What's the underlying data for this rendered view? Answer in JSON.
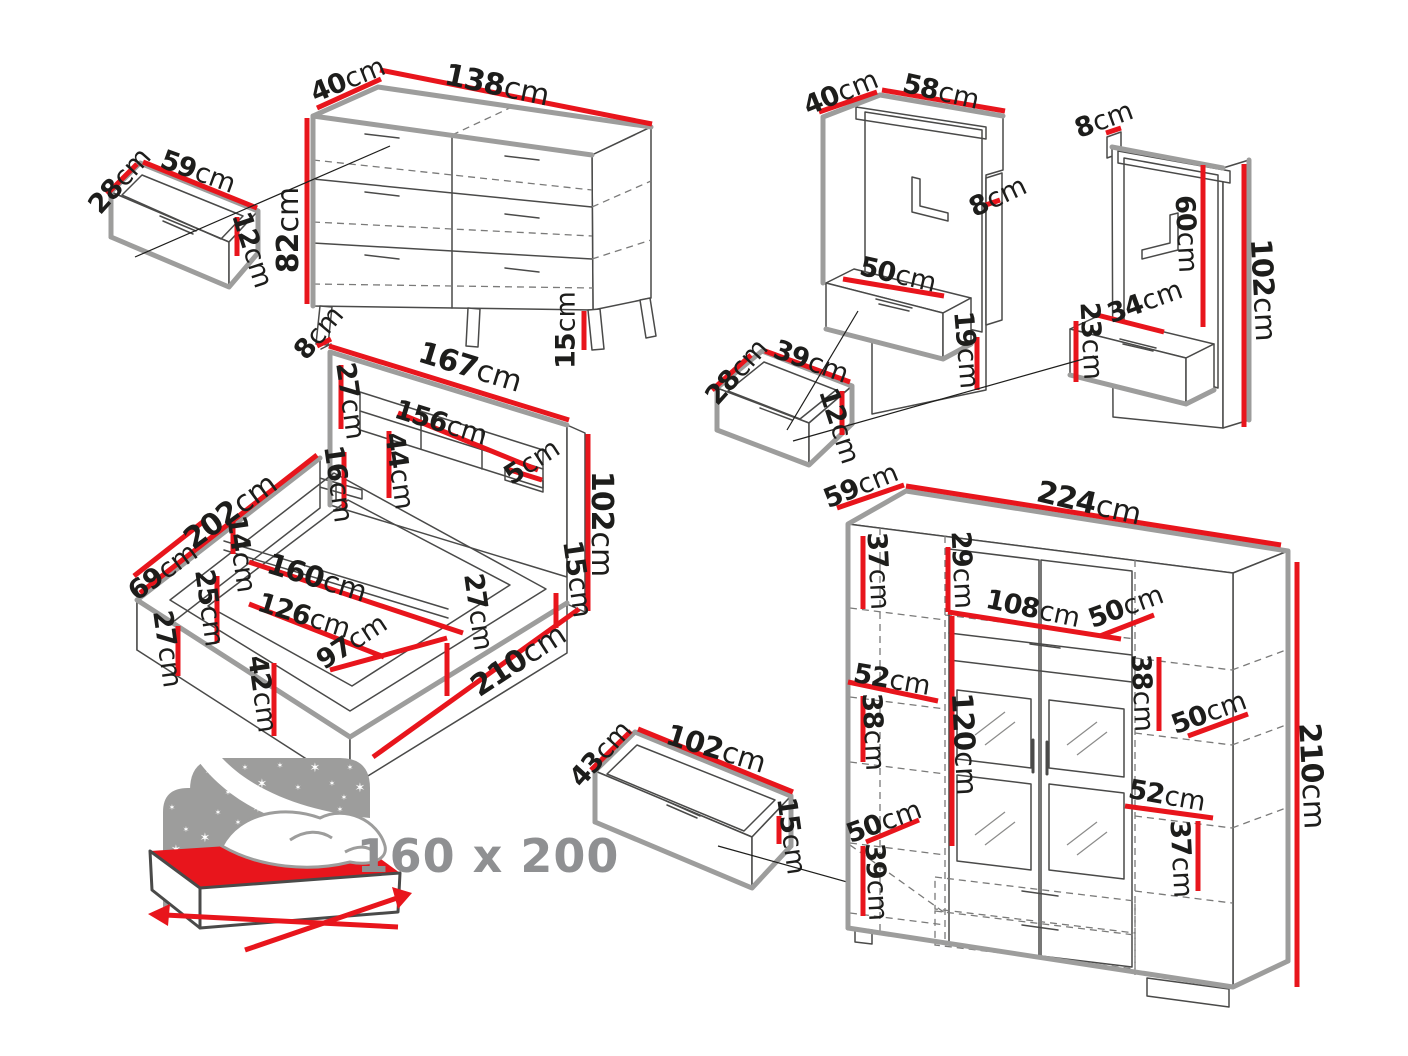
{
  "title": "Bedroom furniture set dimensions diagram",
  "unit": "cm",
  "bed_size_label": "160 x 200",
  "colors": {
    "dimension_red": "#e8151c",
    "outline_gray": "#9d9d9c",
    "line_dark": "#4a4a49",
    "dashed_gray": "#7a7a79",
    "text_dark": "#1d1d1b",
    "pictogram_gray": "#9d9d9c",
    "pictogram_text_gray": "#8f9092",
    "background": "#ffffff"
  },
  "furniture": [
    {
      "name": "chest-of-drawers",
      "dimension_labels_cm": [
        40,
        138,
        82,
        15
      ]
    },
    {
      "name": "chest-drawer-box",
      "dimension_labels_cm": [
        28,
        59,
        12
      ]
    },
    {
      "name": "bed-frame",
      "dimension_labels_cm": [
        8,
        167,
        27,
        156,
        44,
        16,
        5,
        102,
        202,
        14,
        160,
        126,
        69,
        25,
        97,
        27,
        42,
        27,
        15,
        210
      ]
    },
    {
      "name": "under-bed-drawer",
      "dimension_labels_cm": [
        43,
        102,
        15
      ]
    },
    {
      "name": "wall-panel-left",
      "dimension_labels_cm": [
        40,
        58,
        8,
        50,
        19
      ]
    },
    {
      "name": "wall-panel-right",
      "dimension_labels_cm": [
        8,
        60,
        102,
        34,
        23
      ]
    },
    {
      "name": "bedside-drawer-box",
      "dimension_labels_cm": [
        28,
        39,
        12
      ]
    },
    {
      "name": "wardrobe",
      "dimension_labels_cm": [
        59,
        224,
        37,
        29,
        108,
        50,
        52,
        38,
        120,
        38,
        50,
        52,
        37,
        50,
        39,
        210
      ]
    }
  ],
  "labels": [
    {
      "num": "28",
      "x": 120,
      "y": 181,
      "rot": -48,
      "size": 27
    },
    {
      "num": "59",
      "x": 198,
      "y": 172,
      "rot": 20,
      "size": 27
    },
    {
      "num": "12",
      "x": 252,
      "y": 250,
      "rot": 72,
      "size": 27
    },
    {
      "num": "40",
      "x": 348,
      "y": 80,
      "rot": -22,
      "size": 27
    },
    {
      "num": "138",
      "x": 497,
      "y": 86,
      "rot": 12,
      "size": 30
    },
    {
      "num": "82",
      "x": 289,
      "y": 230,
      "rot": -90,
      "size": 30
    },
    {
      "num": "15",
      "x": 566,
      "y": 330,
      "rot": -90,
      "size": 27
    },
    {
      "num": "8",
      "x": 319,
      "y": 333,
      "rot": -50,
      "size": 27
    },
    {
      "num": "167",
      "x": 470,
      "y": 368,
      "rot": 17,
      "size": 30
    },
    {
      "num": "27",
      "x": 350,
      "y": 401,
      "rot": 82,
      "size": 27
    },
    {
      "num": "156",
      "x": 441,
      "y": 423,
      "rot": 17,
      "size": 27
    },
    {
      "num": "44",
      "x": 399,
      "y": 471,
      "rot": 82,
      "size": 27
    },
    {
      "num": "16",
      "x": 338,
      "y": 484,
      "rot": 82,
      "size": 27
    },
    {
      "num": "5",
      "x": 532,
      "y": 462,
      "rot": -33,
      "size": 27
    },
    {
      "num": "102",
      "x": 601,
      "y": 524,
      "rot": 90,
      "size": 30
    },
    {
      "num": "202",
      "x": 231,
      "y": 512,
      "rot": -36,
      "size": 30
    },
    {
      "num": "14",
      "x": 241,
      "y": 554,
      "rot": 82,
      "size": 27
    },
    {
      "num": "69",
      "x": 163,
      "y": 572,
      "rot": -36,
      "size": 27
    },
    {
      "num": "160",
      "x": 317,
      "y": 578,
      "rot": 17,
      "size": 29
    },
    {
      "num": "126",
      "x": 304,
      "y": 616,
      "rot": 17,
      "size": 27
    },
    {
      "num": "25",
      "x": 209,
      "y": 608,
      "rot": 82,
      "size": 27
    },
    {
      "num": "97",
      "x": 352,
      "y": 642,
      "rot": -33,
      "size": 27
    },
    {
      "num": "27",
      "x": 167,
      "y": 649,
      "rot": 82,
      "size": 27
    },
    {
      "num": "42",
      "x": 262,
      "y": 694,
      "rot": 82,
      "size": 27
    },
    {
      "num": "27",
      "x": 478,
      "y": 612,
      "rot": 82,
      "size": 27
    },
    {
      "num": "15",
      "x": 577,
      "y": 579,
      "rot": 82,
      "size": 27
    },
    {
      "num": "210",
      "x": 519,
      "y": 661,
      "rot": -33,
      "size": 30
    },
    {
      "num": "43",
      "x": 601,
      "y": 754,
      "rot": -48,
      "size": 27
    },
    {
      "num": "102",
      "x": 716,
      "y": 749,
      "rot": 17,
      "size": 29
    },
    {
      "num": "15",
      "x": 791,
      "y": 836,
      "rot": 82,
      "size": 27
    },
    {
      "num": "40",
      "x": 841,
      "y": 93,
      "rot": -22,
      "size": 27
    },
    {
      "num": "58",
      "x": 941,
      "y": 92,
      "rot": 13,
      "size": 27
    },
    {
      "num": "8",
      "x": 998,
      "y": 197,
      "rot": -25,
      "size": 27
    },
    {
      "num": "50",
      "x": 898,
      "y": 275,
      "rot": 13,
      "size": 27
    },
    {
      "num": "19",
      "x": 966,
      "y": 350,
      "rot": 85,
      "size": 27
    },
    {
      "num": "8",
      "x": 1104,
      "y": 120,
      "rot": -20,
      "size": 27
    },
    {
      "num": "60",
      "x": 1186,
      "y": 234,
      "rot": 87,
      "size": 27
    },
    {
      "num": "102",
      "x": 1263,
      "y": 290,
      "rot": 87,
      "size": 29
    },
    {
      "num": "34",
      "x": 1145,
      "y": 302,
      "rot": -20,
      "size": 27
    },
    {
      "num": "23",
      "x": 1091,
      "y": 341,
      "rot": 87,
      "size": 27
    },
    {
      "num": "28",
      "x": 737,
      "y": 372,
      "rot": -48,
      "size": 27
    },
    {
      "num": "39",
      "x": 811,
      "y": 362,
      "rot": 20,
      "size": 27
    },
    {
      "num": "12",
      "x": 839,
      "y": 426,
      "rot": 72,
      "size": 27
    },
    {
      "num": "59",
      "x": 861,
      "y": 486,
      "rot": -22,
      "size": 27
    },
    {
      "num": "224",
      "x": 1089,
      "y": 504,
      "rot": 13,
      "size": 30
    },
    {
      "num": "37",
      "x": 878,
      "y": 571,
      "rot": 87,
      "size": 27
    },
    {
      "num": "29",
      "x": 962,
      "y": 570,
      "rot": 87,
      "size": 27
    },
    {
      "num": "108",
      "x": 1033,
      "y": 609,
      "rot": 12,
      "size": 27
    },
    {
      "num": "50",
      "x": 1126,
      "y": 607,
      "rot": -20,
      "size": 27
    },
    {
      "num": "52",
      "x": 892,
      "y": 680,
      "rot": 10,
      "size": 27
    },
    {
      "num": "38",
      "x": 873,
      "y": 732,
      "rot": 87,
      "size": 27
    },
    {
      "num": "120",
      "x": 964,
      "y": 744,
      "rot": 87,
      "size": 29
    },
    {
      "num": "38",
      "x": 1142,
      "y": 693,
      "rot": 87,
      "size": 27
    },
    {
      "num": "50",
      "x": 1209,
      "y": 713,
      "rot": -20,
      "size": 27
    },
    {
      "num": "50",
      "x": 884,
      "y": 822,
      "rot": -20,
      "size": 27
    },
    {
      "num": "39",
      "x": 876,
      "y": 882,
      "rot": 87,
      "size": 27
    },
    {
      "num": "52",
      "x": 1167,
      "y": 796,
      "rot": 10,
      "size": 27
    },
    {
      "num": "37",
      "x": 1181,
      "y": 859,
      "rot": 87,
      "size": 27
    },
    {
      "num": "210",
      "x": 1311,
      "y": 776,
      "rot": 87,
      "size": 30
    }
  ]
}
